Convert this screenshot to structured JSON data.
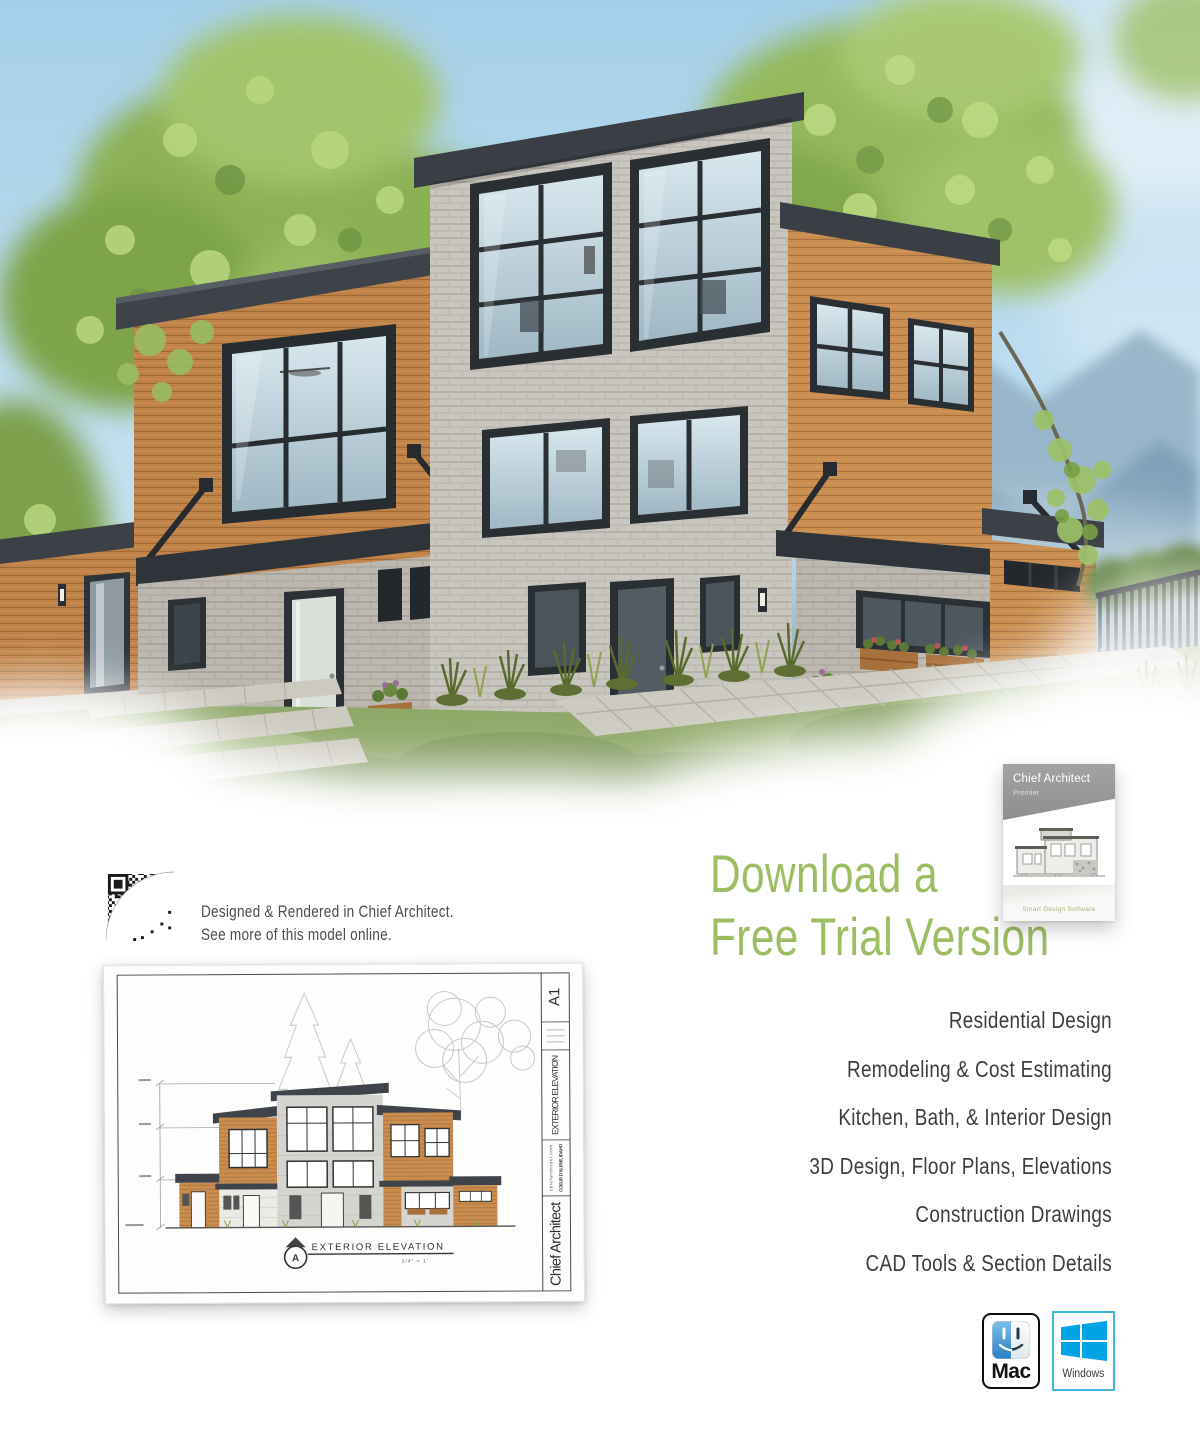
{
  "qr_block": {
    "caption_line1": "Designed & Rendered in Chief Architect.",
    "caption_line2": "See more of this model online."
  },
  "elevation_sheet": {
    "sheet_number": "A1",
    "title_block_heading": "EXTERIOR ELEVATION",
    "title_block_site_line1": "chiefarchitect.com",
    "title_block_site_line2": "COEUR D'ALENE, IDAHO",
    "title_block_brand": "Chief Architect",
    "callout_letter": "A",
    "callout_label": "EXTERIOR ELEVATION",
    "callout_scale": "1/4\" = 1'"
  },
  "promo": {
    "headline_line1": "Download a",
    "headline_line2": "Free Trial Version",
    "features": [
      "Residential Design",
      "Remodeling & Cost Estimating",
      "Kitchen, Bath, & Interior Design",
      "3D Design, Floor Plans, Elevations",
      "Construction Drawings",
      "CAD Tools & Section Details"
    ]
  },
  "product_box": {
    "brand": "Chief Architect",
    "edition": "Premier",
    "tagline": "Smart Design Software"
  },
  "platforms": {
    "mac_label": "Mac",
    "windows_label": "Windows"
  },
  "icons": {
    "qr": "qr-code",
    "mac": "finder-face-icon",
    "windows": "windows-logo-icon"
  },
  "colors": {
    "accent_green": "#9dbd62",
    "windows_blue": "#00a3e4",
    "mac_black": "#0d0d0d"
  }
}
